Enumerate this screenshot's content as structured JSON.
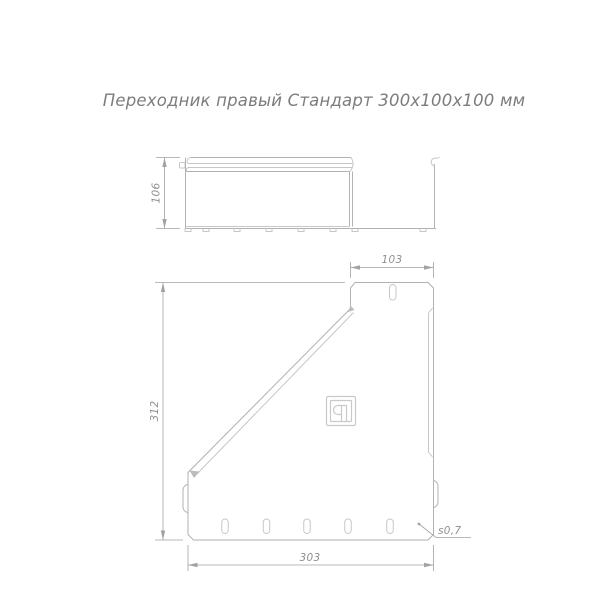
{
  "title": "Переходник правый Стандарт 300х100х100 мм",
  "views": {
    "side": {
      "name": "side-view",
      "dim_height": "106"
    },
    "front": {
      "name": "front-view",
      "dim_top_width": "103",
      "dim_height": "312",
      "dim_bottom_width": "303",
      "thickness_note": "s0,7"
    }
  },
  "icons": {
    "logo": "manufacturer-stamp-icon"
  },
  "colors": {
    "outline": "#b2b2b2",
    "detail": "#c7c7c7",
    "dimension": "#a2a2a2",
    "title_text": "#7c7c7c",
    "background": "#ffffff"
  }
}
